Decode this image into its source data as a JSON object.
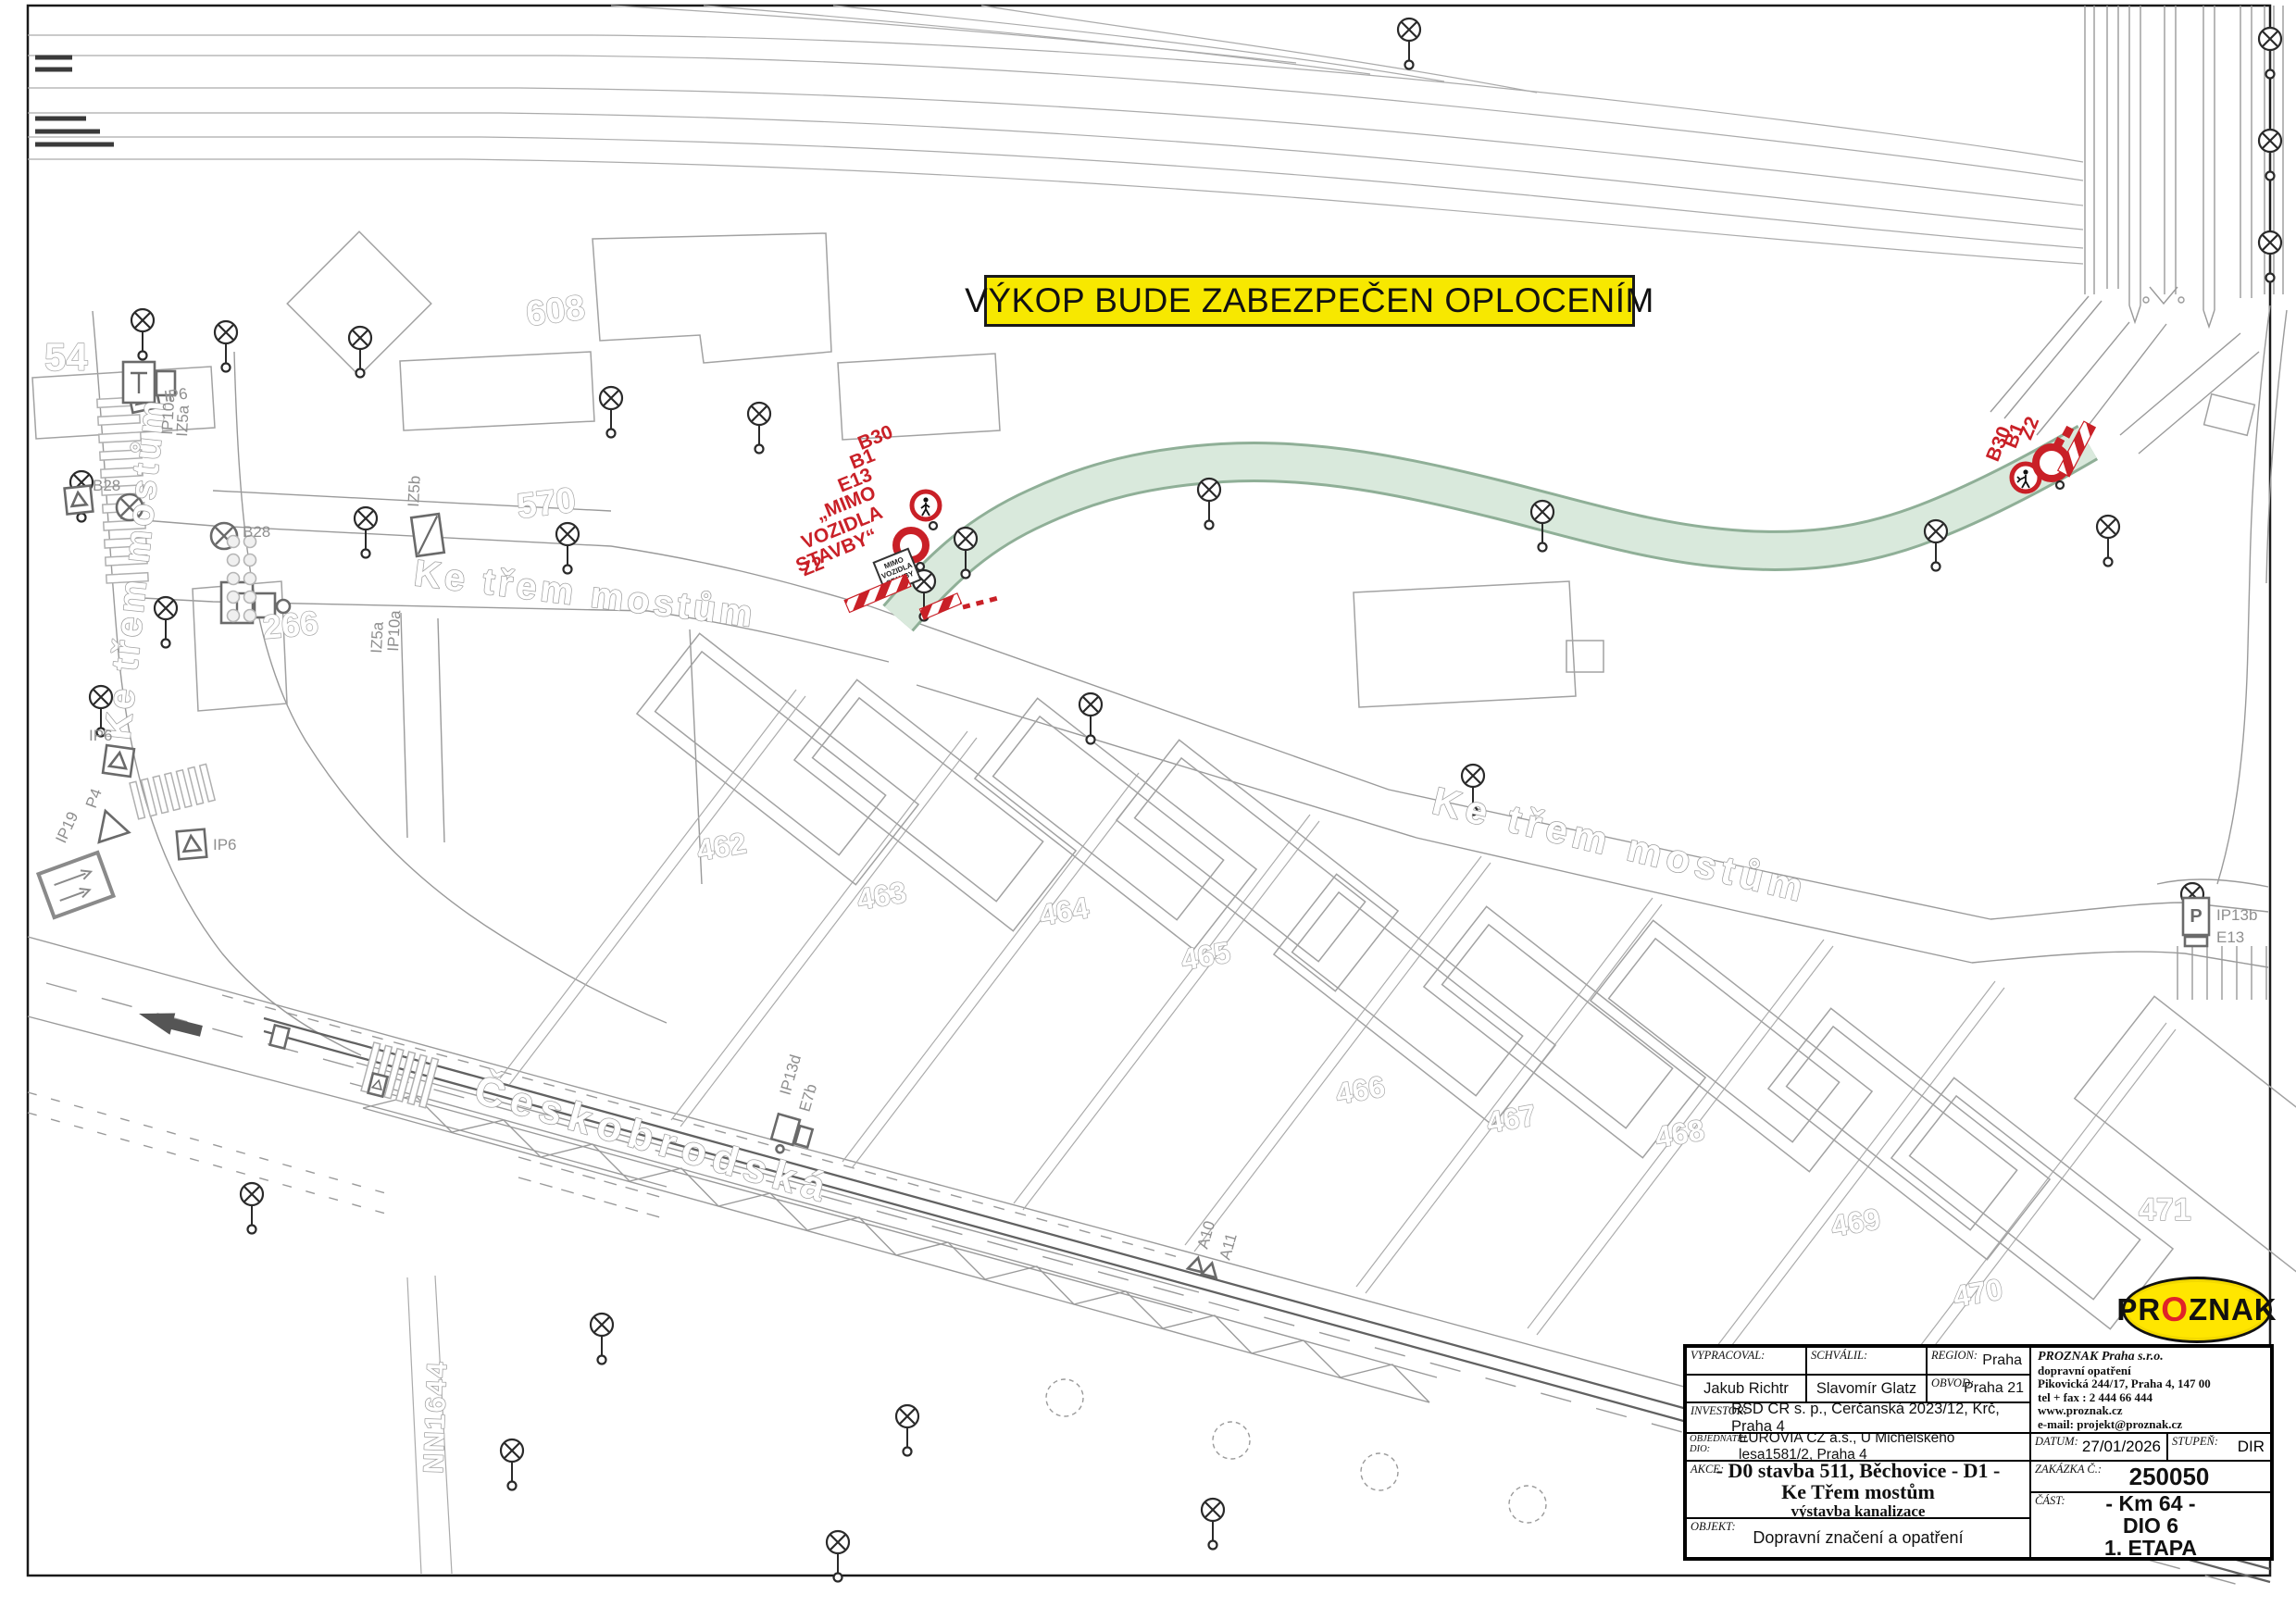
{
  "banner": {
    "text": "VÝKOP BUDE ZABEZPEČEN OPLOCENÍM",
    "bg": "#F7E800"
  },
  "colors": {
    "route_fill": "#D9E9DC",
    "route_edge": "#8FAF97",
    "red": "#C92027",
    "line_gray": "#9A9A9A",
    "label_gray": "#B5B5B5"
  },
  "logo": {
    "pr": "PR",
    "o": "O",
    "znak": "ZNAK"
  },
  "streets": {
    "ke_trem": "Ke třem mostům",
    "ceskobrodska": "Českobrodská",
    "nn": "NN1644"
  },
  "buildings": {
    "b54": "54",
    "b266": "266",
    "b570": "570",
    "b608": "608",
    "b462": "462",
    "b463": "463",
    "b464": "464",
    "b465": "465",
    "b466": "466",
    "b467": "467",
    "b468": "468",
    "b469": "469",
    "b470": "470",
    "b471": "471"
  },
  "signs": {
    "ip6": "IP6",
    "b28": "B28",
    "iz5b": "IZ5b",
    "ip10a": "IP10a",
    "iz5a": "IZ5a",
    "p4": "P4",
    "ip19": "IP19",
    "ip13d": "IP13d",
    "e7b": "E7b",
    "a10": "A10",
    "a11": "A11",
    "ip13b": "IP13b",
    "e13": "E13",
    "p_glyph": "P"
  },
  "closure_left": {
    "lines": [
      "B30",
      "B1",
      "E13",
      "„MIMO",
      "VOZIDLA",
      "STAVBY“",
      "Z2"
    ],
    "panel": [
      "MIMO",
      "VOZIDLA",
      "STAVBY"
    ]
  },
  "closure_right": {
    "lines": [
      "B30",
      "B1",
      "Z2"
    ]
  },
  "title_block": {
    "vypracoval_label": "VYPRACOVAL:",
    "vypracoval": "Jakub Richtr",
    "schvalil_label": "SCHVÁLIL:",
    "schvalil": "Slavomír Glatz",
    "region_label": "REGION:",
    "region": "Praha",
    "obvod_label": "OBVOD:",
    "obvod": "Praha 21",
    "company_name": "PROZNAK  Praha s.r.o.",
    "company_lines": [
      "dopravní opatření",
      "Pikovická 244/17, Praha 4, 147 00",
      "tel + fax : 2 444 66 444",
      "www.proznak.cz",
      "e-mail:    projekt@proznak.cz",
      "projekce: richtr@proznak.cz"
    ],
    "investor_label": "INVESTOR:",
    "investor": "ŘSD ČR s. p., Čerčanská 2023/12, Krč, Praha 4",
    "objednatel_label": "OBJEDNATEL",
    "dio_label": "DIO:",
    "objednatel": "EUROVIA CZ a.s., U Michelského lesa1581/2, Praha 4",
    "datum_label": "DATUM:",
    "datum": "27/01/2026",
    "stupen_label": "STUPEŇ:",
    "stupen": "DIR",
    "akce_label": "AKCE:",
    "akce_lines": [
      "- D0 stavba 511, Běchovice - D1 -",
      "Ke Třem mostům",
      "výstavba kanalizace"
    ],
    "zakazka_label": "ZAKÁZKA Č.:",
    "zakazka": "250050",
    "cast_label": "ČÁST:",
    "cast_lines": [
      "- Km 64 -",
      "DIO 6",
      "1. ETAPA"
    ],
    "objekt_label": "OBJEKT:",
    "objekt": "Dopravní značení a opatření"
  }
}
